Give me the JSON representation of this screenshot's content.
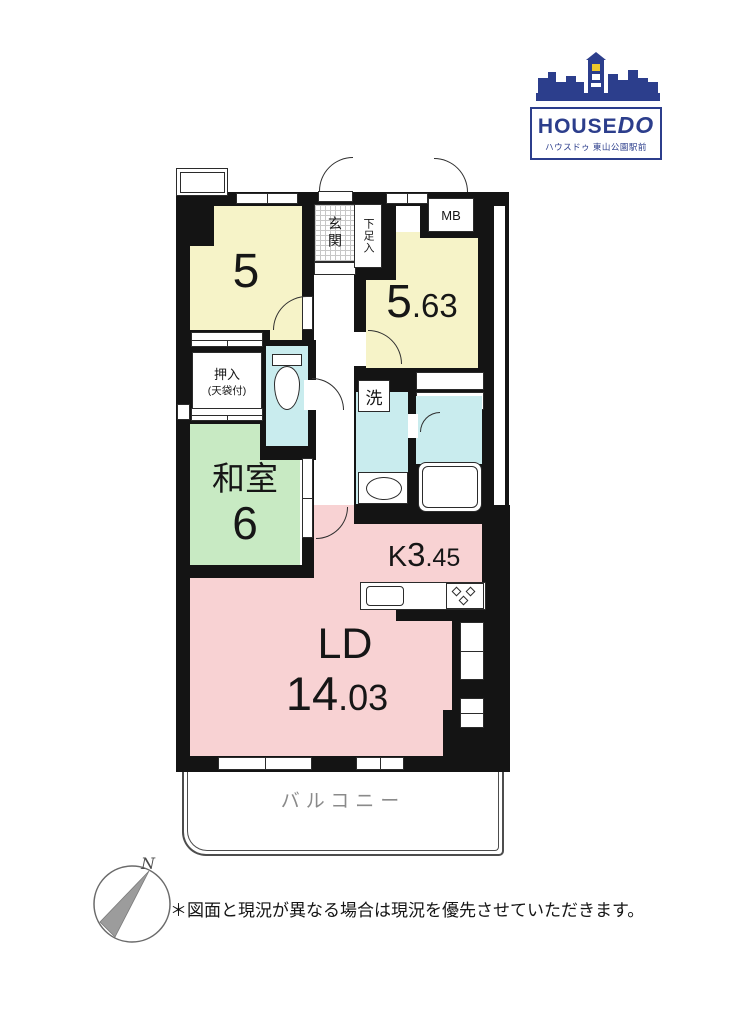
{
  "logo": {
    "brand_house": "HOUSE",
    "brand_do": "DO",
    "subtitle": "ハウスドゥ 東山公園駅前",
    "navy": "#2c3e8c"
  },
  "plan": {
    "rooms": {
      "bedroom1": {
        "label": "5"
      },
      "bedroom2": {
        "main": "5",
        "decimal": ".63"
      },
      "washitsu": {
        "name": "和室",
        "size": "6"
      },
      "kitchen": {
        "name": "K",
        "main": "3",
        "decimal": ".45"
      },
      "living": {
        "name": "LD",
        "main": "14",
        "decimal": ".03"
      },
      "balcony": {
        "label": "バルコニー"
      }
    },
    "features": {
      "genkan": "玄関",
      "shoe_storage": "下足入",
      "meter_box": "MB",
      "closet_line1": "押入",
      "closet_line2": "(天袋付)",
      "laundry": "洗"
    },
    "compass": {
      "north": "N"
    },
    "colors": {
      "bedroom": "#f6f3c8",
      "tatami": "#c8eac3",
      "wet": "#c9ecee",
      "living": "#f8d2d3",
      "wall": "#141414"
    }
  },
  "footer": {
    "disclaimer": "＊図面と現況が異なる場合は現況を優先させていただきます。"
  }
}
